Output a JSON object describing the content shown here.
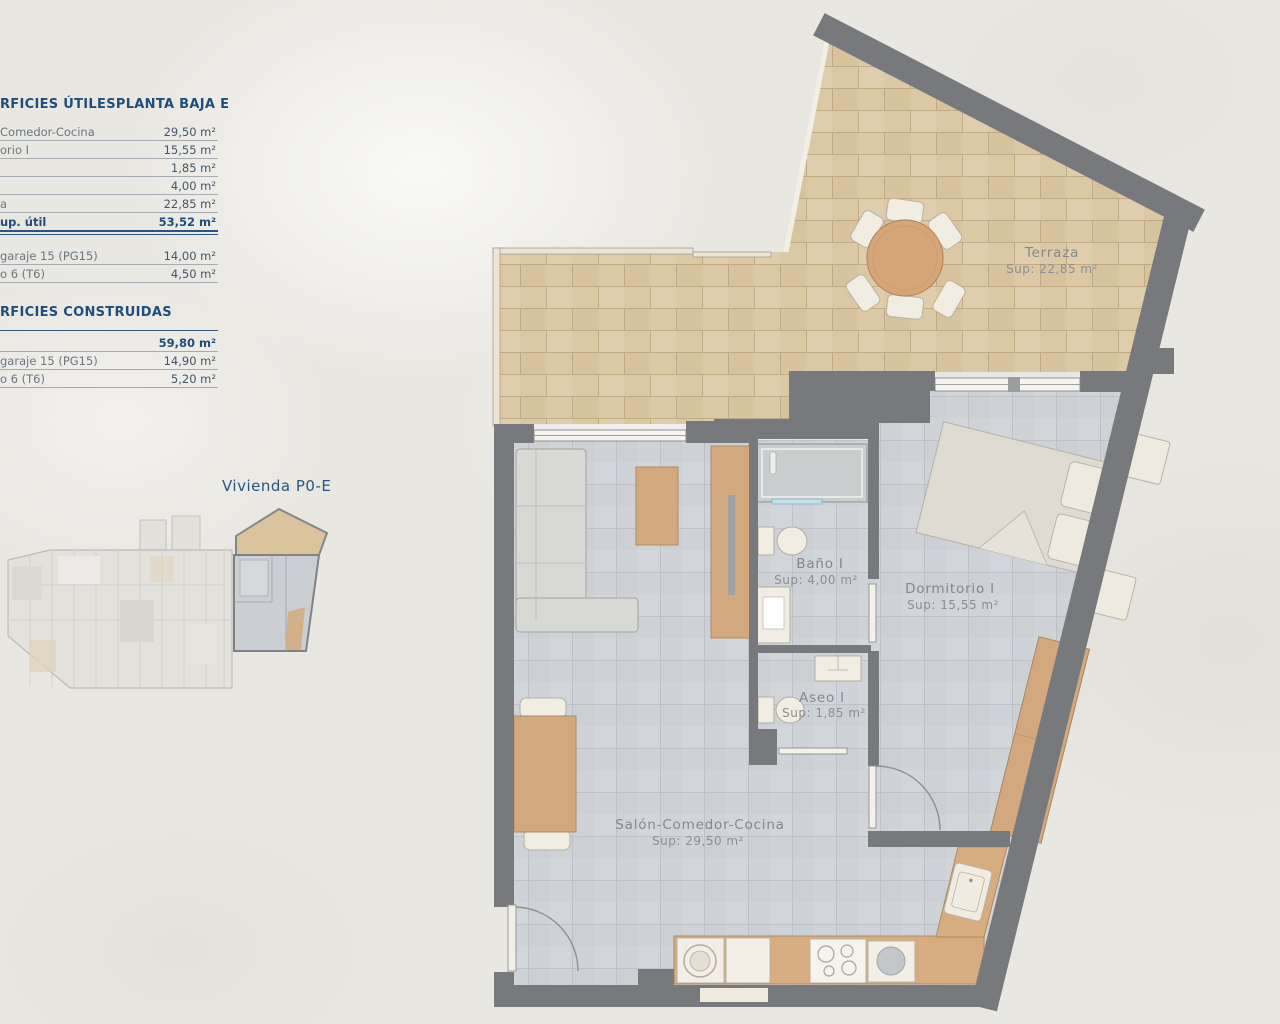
{
  "panel": {
    "t1": {
      "header_left": "RFICIES ÚTILES",
      "header_right": "PLANTA BAJA E",
      "rows": [
        {
          "label": "Comedor-Cocina",
          "value": "29,50 m²"
        },
        {
          "label": "orio I",
          "value": "15,55 m²"
        },
        {
          "label": "",
          "value": "1,85 m²"
        },
        {
          "label": "",
          "value": "4,00 m²"
        },
        {
          "label": "a",
          "value": "22,85 m²"
        },
        {
          "label": "up. útil",
          "value": "53,52 m²",
          "total": true
        }
      ],
      "rows2": [
        {
          "label": "garaje 15 (PG15)",
          "value": "14,00 m²"
        },
        {
          "label": "o 6 (T6)",
          "value": "4,50 m²"
        }
      ]
    },
    "t2": {
      "header": "RFICIES CONSTRUIDAS",
      "rows": [
        {
          "label": "",
          "value": "59,80 m²",
          "bold": true
        },
        {
          "label": "garaje 15 (PG15)",
          "value": "14,90 m²"
        },
        {
          "label": "o 6 (T6)",
          "value": "5,20 m²"
        }
      ]
    },
    "vivienda_label": "Vivienda P0-E"
  },
  "plan": {
    "rooms": [
      {
        "name": "Terraza",
        "sup": "Sup: 22,85 m²"
      },
      {
        "name": "Baño I",
        "sup": "Sup: 4,00 m²"
      },
      {
        "name": "Dormitorio I",
        "sup": "Sup: 15,55 m²"
      },
      {
        "name": "Aseo I",
        "sup": "Sup: 1,85 m²"
      },
      {
        "name": "Salón-Comedor-Cocina",
        "sup": "Sup: 29,50 m²"
      }
    ]
  },
  "colors": {
    "navy": "#1f4e7d",
    "wall_gray": "#77797c",
    "terrace_tile": "#dbc9a6",
    "interior_tile": "#cfd3d7",
    "wood": "#d2a97e",
    "room_label": "#85888b",
    "background": "#e9e7e2"
  }
}
